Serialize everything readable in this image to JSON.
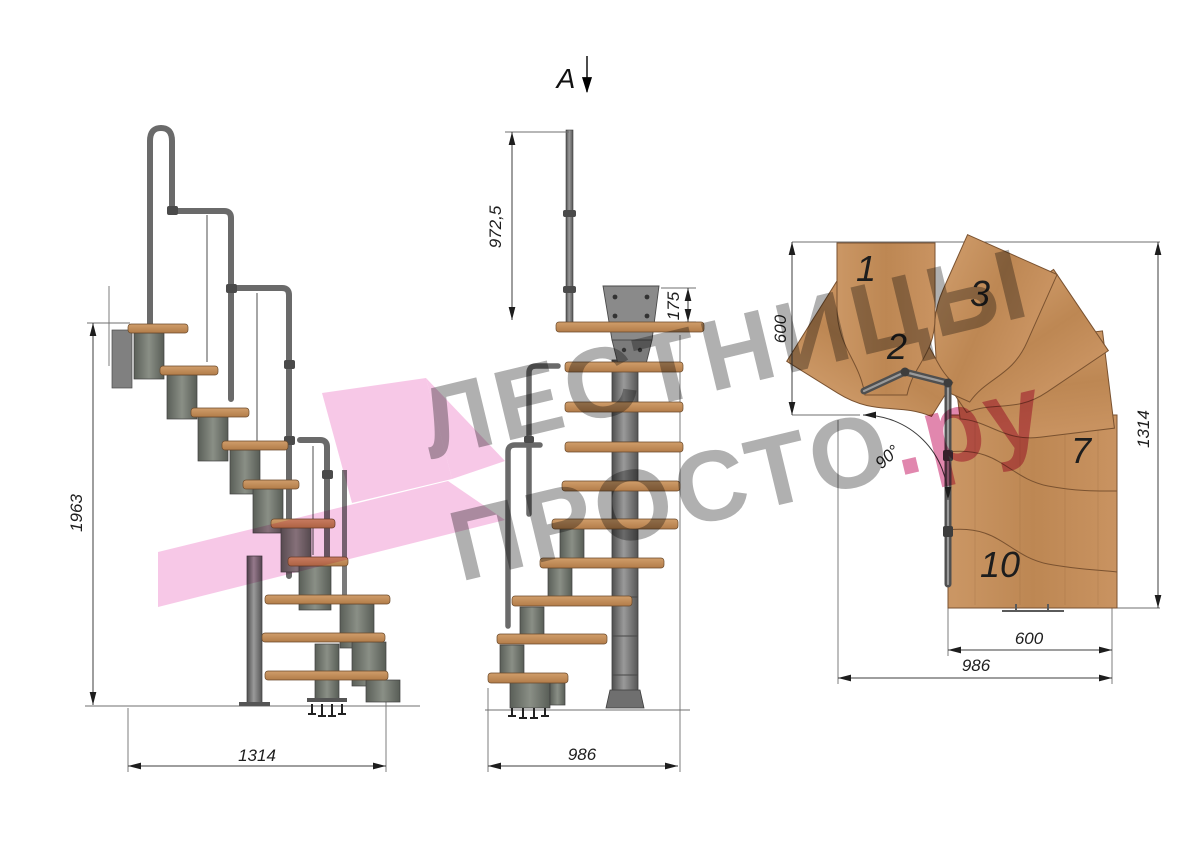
{
  "watermark": {
    "line1": "ЛЕСТНИЦЫ",
    "line2": "ПРОСТО",
    "suffix": ".ру"
  },
  "colors": {
    "wood": "#c6915e",
    "wood_dark": "#a87848",
    "metal": "#6f6f6f",
    "dim_line": "#3c3c3c",
    "watermark_gray": "#7f7f7f",
    "watermark_pink": "#cf3d7c",
    "highlight_pink": "#f4b3de"
  },
  "views": {
    "side": {
      "dim_total_height": "1963",
      "dim_total_run": "1314"
    },
    "front": {
      "section_mark": "A",
      "dim_rail_height": "972,5",
      "dim_bracket_height": "175",
      "dim_total_width": "986"
    },
    "plan": {
      "dim_upper_flight_depth": "600",
      "dim_total_length": "1314",
      "dim_turn_angle": "90°",
      "dim_lower_flight_width": "600",
      "dim_total_depth": "986",
      "steps": {
        "s1": "1",
        "s2": "2",
        "s3": "3",
        "s7": "7",
        "s10": "10"
      }
    }
  }
}
